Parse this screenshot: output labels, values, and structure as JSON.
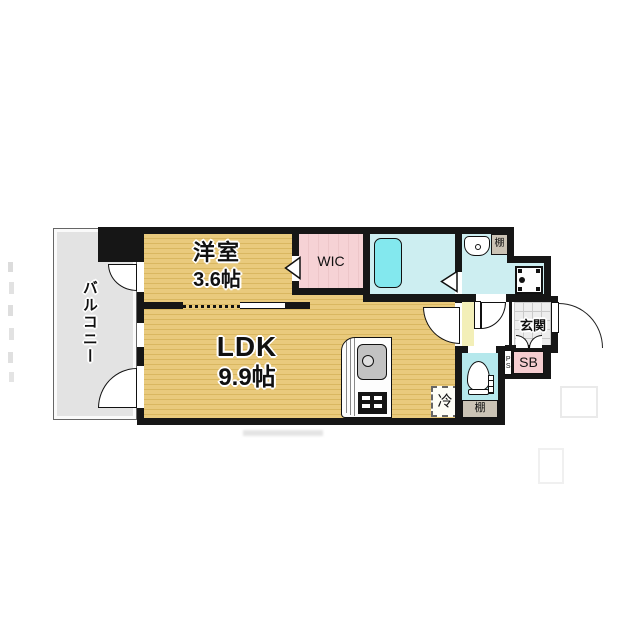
{
  "rooms": {
    "yoshitsu": {
      "name": "洋室",
      "size": "3.6帖"
    },
    "ldk": {
      "name": "LDK",
      "size": "9.9帖"
    },
    "wic": {
      "label": "WIC"
    },
    "balcony": {
      "label": "バルコニー"
    },
    "genkan": {
      "label": "玄関"
    }
  },
  "labels": {
    "shoe_box": "SB",
    "pipe_space": "PS",
    "refrigerator": "冷",
    "shelf_washroom": "棚",
    "shelf_toilet": "棚"
  },
  "colors": {
    "wall": "#161616",
    "floor_wood": "#e9ca7d",
    "floor_stripe": "#d9b761",
    "wic_pink": "#f6d2d5",
    "bath_cyan": "#cdeef1",
    "bathtub_cyan": "#83e8ee",
    "toilet_cyan": "#b5e8ec",
    "balcony_gray": "#e3e3e3",
    "hallway_yellow": "#f3efb8",
    "tile_gray": "#ededed",
    "shelf_tan": "#cbc3b5",
    "sb_pink": "#f5cdd0"
  }
}
